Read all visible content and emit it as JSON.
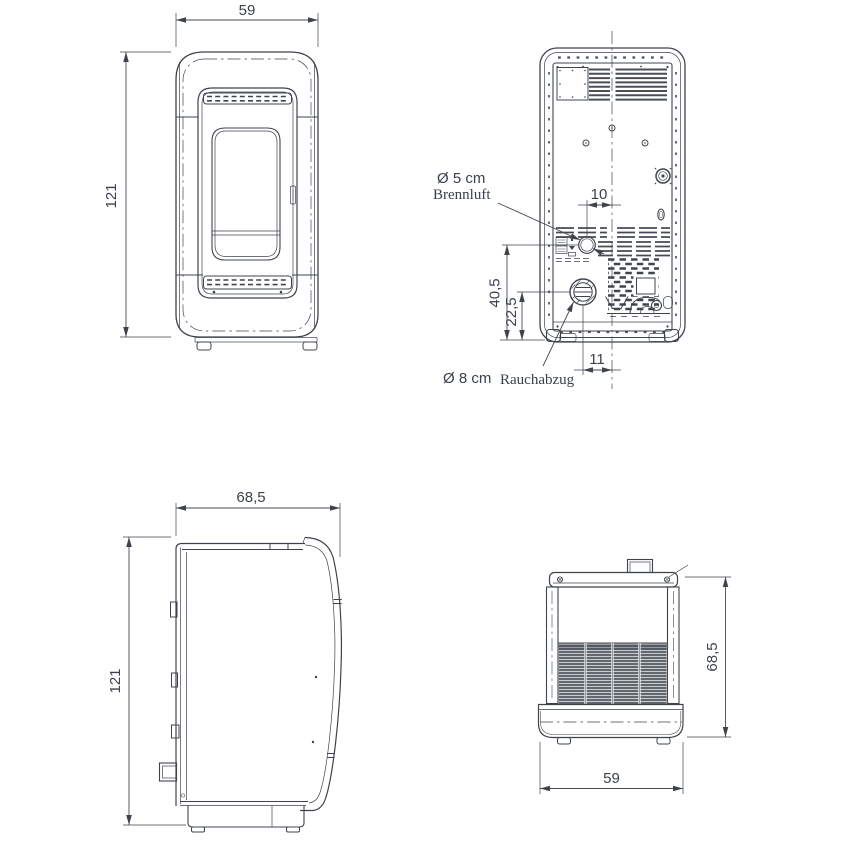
{
  "colors": {
    "line": "#3f444c",
    "text": "#3b414c",
    "grille_fill": "#c6c9ce",
    "vent_fill": "#dfe1e5",
    "background": "#ffffff"
  },
  "views": {
    "front": {
      "width": "59",
      "height": "121"
    },
    "back": {
      "air_inlet_offset": "10",
      "air_inlet_height": "40,5",
      "flue_outlet_height": "22,5",
      "flue_outlet_offset": "11",
      "air_inlet_diameter": "Ø 5 cm",
      "air_inlet_label": "Brennluft",
      "flue_outlet_diameter": "Ø 8 cm",
      "flue_outlet_label": "Rauchabzug"
    },
    "side": {
      "depth": "68,5",
      "height": "121"
    },
    "top": {
      "depth": "68,5",
      "width": "59"
    }
  }
}
